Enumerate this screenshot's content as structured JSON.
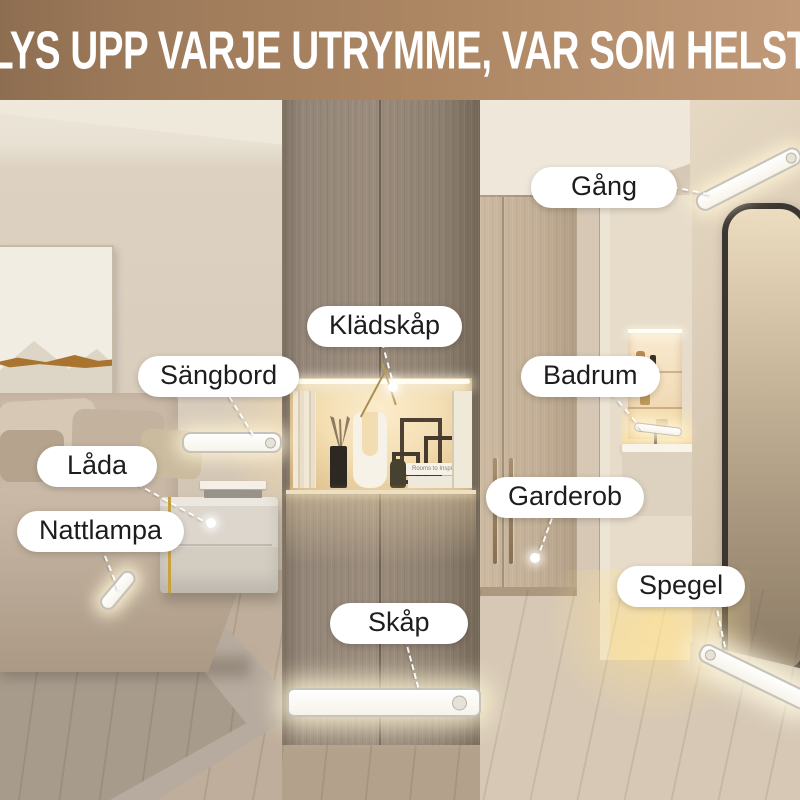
{
  "header": {
    "title": "LYS UPP VARJE UTRYMME, VAR SOM HELST",
    "bg_gradient": [
      "#8e6e51",
      "#c09a78"
    ],
    "text_color": "#ffffff"
  },
  "labels": [
    {
      "id": "gang",
      "text": "Gång"
    },
    {
      "id": "kladskap",
      "text": "Klädskåp"
    },
    {
      "id": "sangbord",
      "text": "Sängbord"
    },
    {
      "id": "badrum",
      "text": "Badrum"
    },
    {
      "id": "lada",
      "text": "Låda"
    },
    {
      "id": "garderob",
      "text": "Garderob"
    },
    {
      "id": "nattlampa",
      "text": "Nattlampa"
    },
    {
      "id": "spegel",
      "text": "Spegel"
    },
    {
      "id": "skap",
      "text": "Skåp"
    }
  ],
  "scene": {
    "book_title": "Rooms to Inspire",
    "colors": {
      "pill_bg": "#ffffff",
      "pill_text": "#1d1d1d",
      "callout_line": "#ffffff",
      "light_glow": "#fff5d6",
      "cabinet_wood": "#9b8c7c",
      "wardrobe_wood": "#c3af96",
      "bedroom_wall": "#ddd1c1",
      "niche_glow": "#f4dfb4"
    },
    "light_bar_count": 9
  }
}
